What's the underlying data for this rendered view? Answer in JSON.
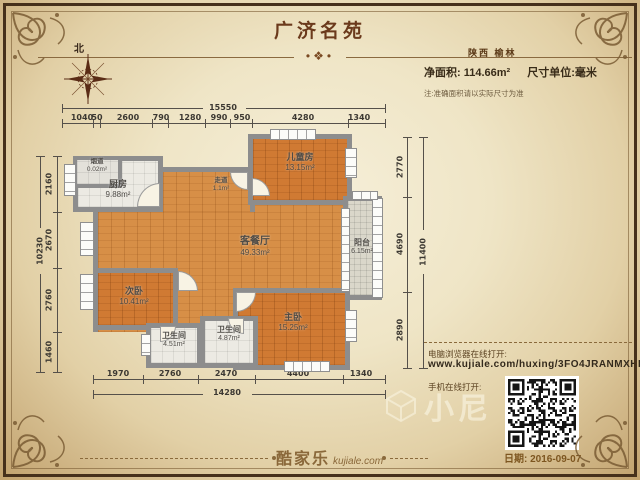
{
  "header": {
    "title": "广济名苑",
    "ornament": "•❖•",
    "region": "陕西 榆林",
    "net_area_label": "净面积: 114.66m²",
    "unit_label": "尺寸单位:毫米",
    "note": "注:准确面积请以实际尺寸为准",
    "compass_north": "北"
  },
  "rooms": {
    "flue": {
      "name": "烟道",
      "area": "0.02m²"
    },
    "kitchen": {
      "name": "厨房",
      "area": "9.88m²"
    },
    "corridor": {
      "name": "走道",
      "area": "1.1m²"
    },
    "kids": {
      "name": "儿童房",
      "area": "13.15m²"
    },
    "living": {
      "name": "客餐厅",
      "area": "49.33m²"
    },
    "balcony": {
      "name": "阳台",
      "area": "6.15m²"
    },
    "bed2": {
      "name": "次卧",
      "area": "10.41m²"
    },
    "bath1": {
      "name": "卫生间",
      "area": "4.51m²"
    },
    "bath2": {
      "name": "卫生间",
      "area": "4.87m²"
    },
    "master": {
      "name": "主卧",
      "area": "15.25m²"
    }
  },
  "dims": {
    "top": {
      "total": "15550",
      "segments": [
        "1040",
        "50",
        "2600",
        "790",
        "1280",
        "990",
        "950",
        "4280",
        "1340"
      ]
    },
    "bottom": {
      "total": "14280",
      "segments": [
        "1970",
        "2760",
        "2470",
        "4400",
        "1340"
      ]
    },
    "left": {
      "total": "10230",
      "segments": [
        "2160",
        "2670",
        "2760",
        "1460"
      ]
    },
    "right": {
      "total": "11400",
      "segments": [
        "2770",
        "4690",
        "2890"
      ]
    }
  },
  "links": {
    "pc_label": "电脑浏览器在线打开:",
    "url": "www.kujiale.com/huxing/3FO4JRANMXHL",
    "mobile_label": "手机在线打开:"
  },
  "footer": {
    "brand": "酷家乐",
    "brand_domain": "kujiale.com",
    "date": "日期: 2016-09-07"
  },
  "watermark": {
    "text": "小尼"
  },
  "colors": {
    "accent": "#6b3a1c",
    "wall": "#8d8d8d",
    "wood": "#d78f47",
    "frame": "#46321e",
    "paper": "#efe5c6"
  }
}
